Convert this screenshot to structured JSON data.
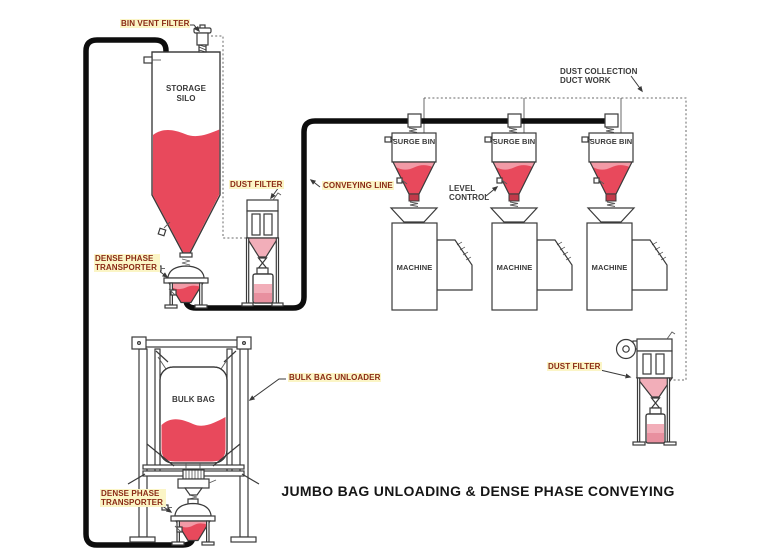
{
  "title": "JUMBO BAG UNLOADING & DENSE PHASE CONVEYING",
  "colors": {
    "red": "#e8495c",
    "red_light": "#f29aa6",
    "pink": "#f2aeb9",
    "pink_dark": "#e8909f",
    "valve_red": "#c23a4a",
    "label_red": "#8a2a15",
    "ink": "#3a3a3a",
    "pipe_black": "#0d0d0d",
    "highlight": "#fbf5c6",
    "title_ink": "#161616"
  },
  "labels": {
    "bin_vent_filter": "BIN VENT FILTER",
    "storage_silo": "STORAGE SILO",
    "dust_filter": "DUST FILTER",
    "conveying_line": "CONVEYING LINE",
    "dense_phase_transporter": "DENSE PHASE TRANSPORTER",
    "surge_bin": "SURGE BIN",
    "level_control": "LEVEL CONTROL",
    "dust_collection_duct_work": "DUST COLLECTION DUCT WORK",
    "machine": "MACHINE",
    "bulk_bag": "BULK BAG",
    "bulk_bag_unloader": "BULK BAG UNLOADER"
  }
}
